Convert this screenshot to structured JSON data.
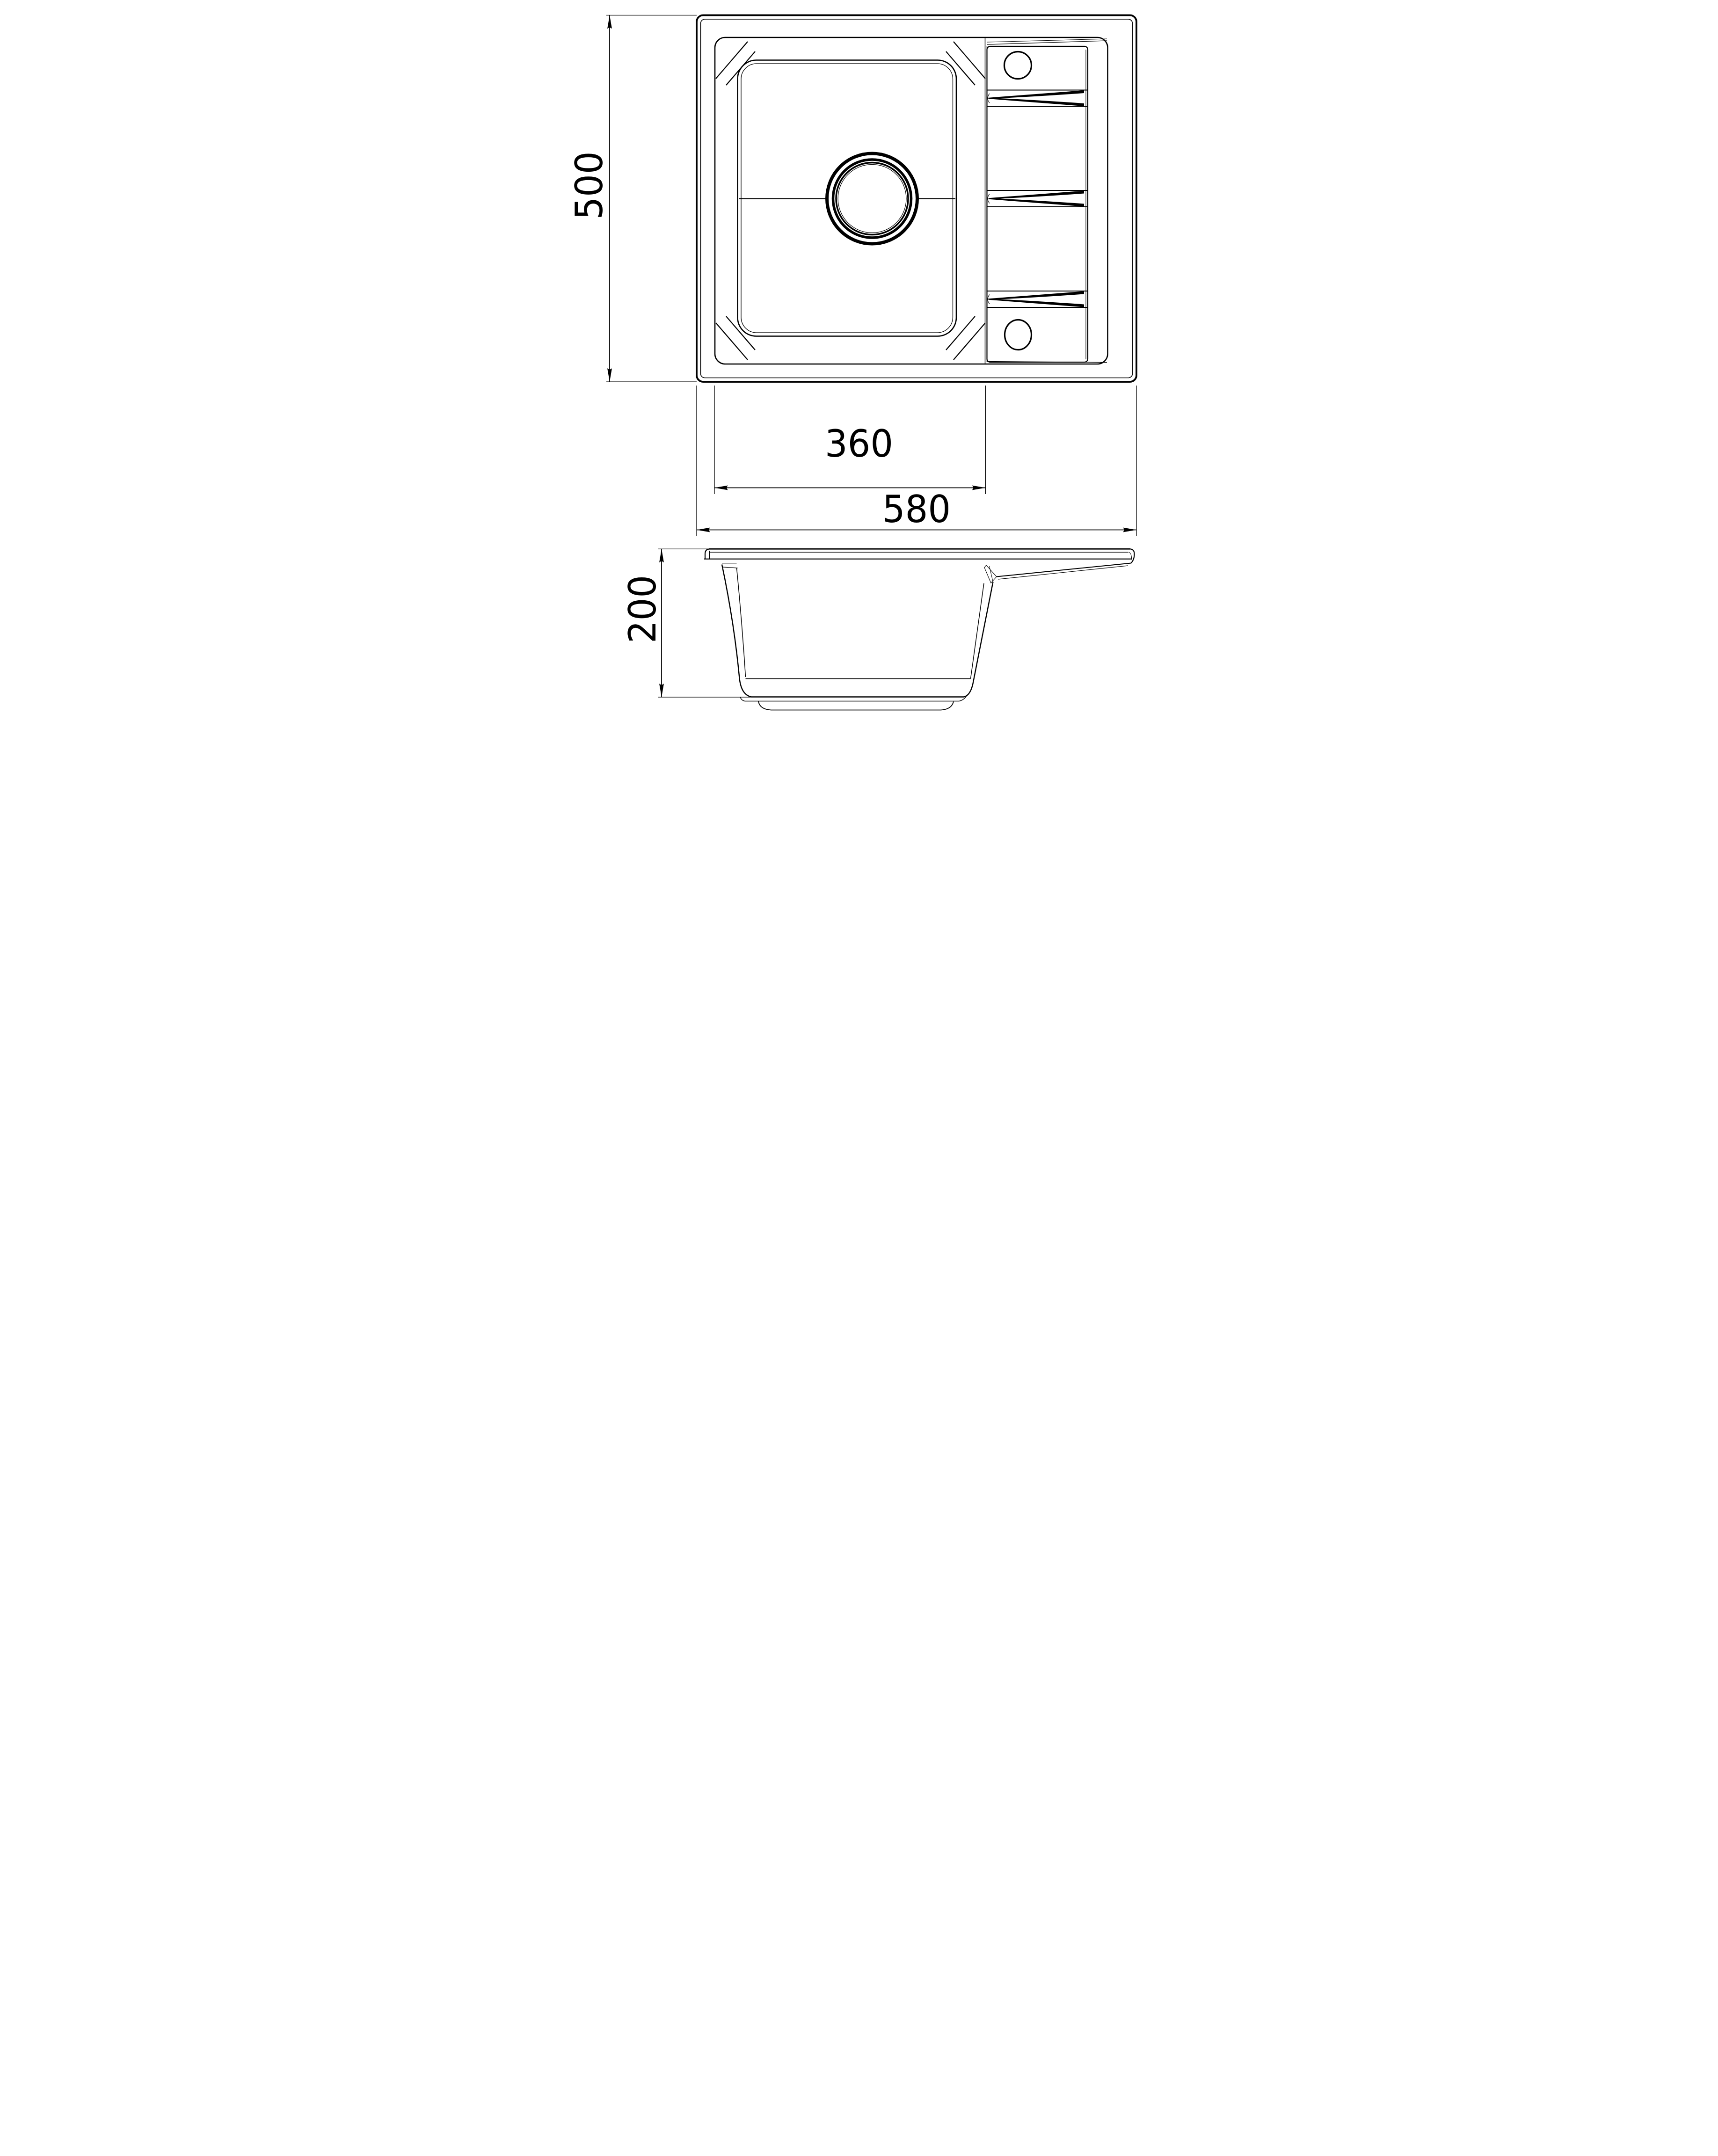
{
  "drawing": {
    "kind": "sink-technical-drawing",
    "colors": {
      "line": "#000000",
      "background": "#ffffff"
    },
    "dimensions": {
      "overall_depth": "500",
      "bowl_width": "360",
      "overall_width": "580",
      "height": "200"
    }
  }
}
